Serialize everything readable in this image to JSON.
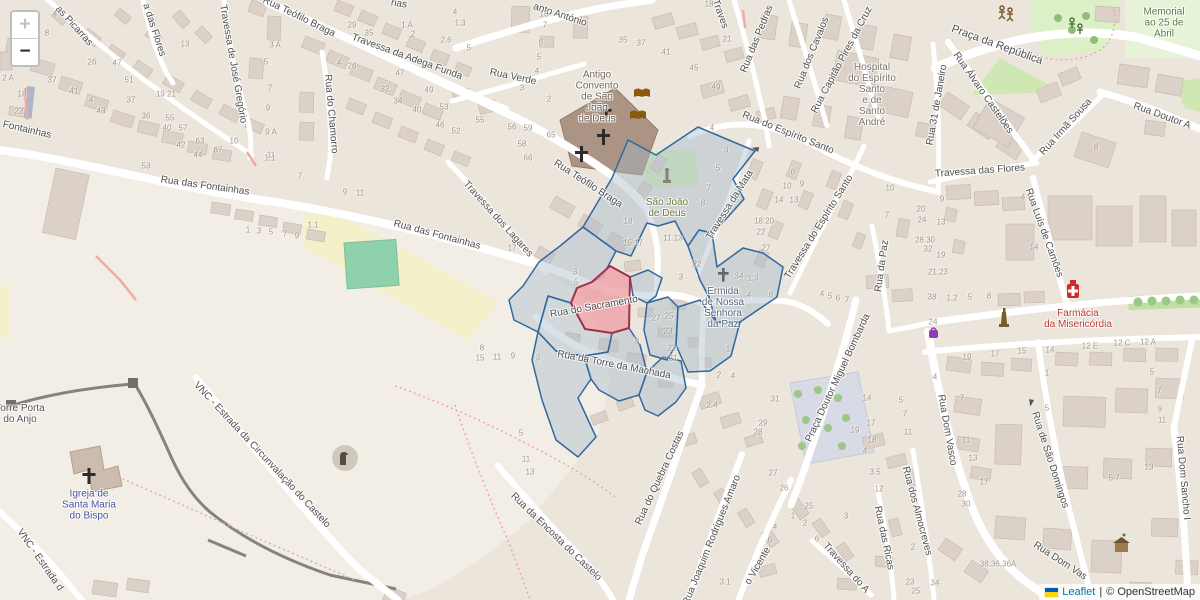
{
  "controls": {
    "zoom_in": "+",
    "zoom_out": "−"
  },
  "attribution": {
    "leaflet": "Leaflet",
    "separator": "|",
    "osm": "© OpenStreetMap"
  },
  "colors": {
    "overlay_stroke": "#31689e",
    "overlay_fill": "rgba(164,183,203,0.42)",
    "selected_stroke": "#a23148",
    "selected_fill": "rgba(237,166,171,0.85)",
    "link": "#0078a8"
  },
  "icons": [
    "church-cross-icon",
    "book-icon",
    "statue-icon",
    "monument-icon",
    "pharmacy-icon",
    "shop-icon",
    "gate-icon",
    "historic-house-icon",
    "castle-tower-icon",
    "playground-icon",
    "tree-icon",
    "oneway-arrow-icon",
    "ukraine-flag-icon",
    "zoom-in-icon",
    "zoom-out-icon"
  ],
  "map": {
    "streets": [
      [
        "Fontainhas",
        27,
        130,
        13
      ],
      [
        "as Picarras",
        74,
        26,
        48
      ],
      [
        "a das Flores",
        154,
        30,
        72
      ],
      [
        "Travessa de José Gregório",
        233,
        64,
        80
      ],
      [
        "Rua Teófilo Braga",
        299,
        17,
        26
      ],
      [
        "rias",
        399,
        4,
        8
      ],
      [
        "Travessa da Adega Funda",
        407,
        57,
        20
      ],
      [
        "Rua Verde",
        513,
        77,
        12
      ],
      [
        "Rua do Chamorro",
        331,
        114,
        85
      ],
      [
        "anto António",
        560,
        15,
        18
      ],
      [
        "Traves",
        720,
        14,
        70
      ],
      [
        "Rua das Pedras",
        757,
        39,
        -68
      ],
      [
        "Rua dos Cavalos",
        812,
        53,
        -68
      ],
      [
        "Rua Capitão Pires da Cruz",
        842,
        60,
        -62
      ],
      [
        "Rua do Espírito Santo",
        788,
        133,
        22
      ],
      [
        "Rua 31 de Janeiro",
        937,
        105,
        -80
      ],
      [
        "Praça da República",
        997,
        45,
        20,
        11
      ],
      [
        "Rua Álvaro Castelões",
        983,
        93,
        55
      ],
      [
        "Rua Irmã Sousa",
        1066,
        127,
        -48
      ],
      [
        "Rua Doutor A",
        1162,
        116,
        20
      ],
      [
        "Travessa das Flores",
        980,
        171,
        -4
      ],
      [
        "Rua Luís de Camões",
        1044,
        233,
        70
      ],
      [
        "Rua da Paz",
        882,
        266,
        -82
      ],
      [
        "Travessa do Espírito Santo",
        819,
        227,
        -58
      ],
      [
        "Travessa da Mata",
        730,
        205,
        -58
      ],
      [
        "Rua Teófilo Braga",
        588,
        184,
        33
      ],
      [
        "Travessa dos Lagares",
        498,
        219,
        48
      ],
      [
        "Rua das Fontainhas",
        205,
        186,
        8
      ],
      [
        "Rua das Fontainhas",
        437,
        235,
        15
      ],
      [
        "Rua do Sacramento",
        594,
        307,
        -10
      ],
      [
        "Rua da Torre da Machada",
        614,
        365,
        11
      ],
      [
        "Rua do Quebra Costas",
        660,
        478,
        -65
      ],
      [
        "Rua Joaquim Rodrigues Amaro",
        712,
        540,
        -68
      ],
      [
        "Praça Doutor Miguel Bombarda",
        838,
        378,
        -65
      ],
      [
        "o Vicente",
        758,
        566,
        -60
      ],
      [
        "Travessa do A",
        846,
        568,
        48
      ],
      [
        "Rua das Ricas",
        884,
        538,
        78
      ],
      [
        "Rua dos Almocreves",
        917,
        511,
        75
      ],
      [
        "Rua Dom Vasco",
        947,
        430,
        80
      ],
      [
        "Rua Dom Vas",
        1060,
        561,
        33
      ],
      [
        "Rua de São Domingos",
        1050,
        460,
        72
      ],
      [
        "Rua Dom Sancho I",
        1183,
        478,
        85
      ],
      [
        "VNC - Estrada da Circunvalação do Castelo",
        262,
        455,
        47
      ],
      [
        "VNC - Estrada d",
        40,
        560,
        55
      ],
      [
        "Rua da Encosta do Castelo",
        556,
        537,
        44
      ]
    ],
    "places": [
      [
        "Antigo\nConvento\nde São\nJoão\nde Deus",
        597,
        97,
        "#75695c"
      ],
      [
        "São João\nde Deus",
        667,
        208,
        "#6f7a3e"
      ],
      [
        "Ermida\nde Nossa\nSenhora\nda Paz",
        723,
        308,
        "#5b6b7c"
      ],
      [
        "Hospital\ndo Espírito\nSanto\ne de\nSanto\nAndré",
        872,
        95,
        "#7d746a"
      ],
      [
        "Torre Porta\ndo Anjo",
        20,
        414,
        "#565656"
      ],
      [
        "Igreja de\nSanta Maria\ndo Bispo",
        89,
        505,
        "#4a549e"
      ],
      [
        "Farmácia\nda Misericórdia",
        1078,
        319,
        "#bf3a34"
      ],
      [
        "Memorial\nao 25 de\nAbril",
        1164,
        23,
        "#5a7d46"
      ]
    ],
    "house_numbers": [
      [
        "4",
        55,
        14
      ],
      [
        "8",
        47,
        33
      ],
      [
        "13",
        185,
        44
      ],
      [
        "26",
        92,
        62
      ],
      [
        "47",
        117,
        63
      ],
      [
        "51",
        129,
        80
      ],
      [
        "37",
        52,
        80
      ],
      [
        "41",
        74,
        91
      ],
      [
        "4",
        91,
        100
      ],
      [
        "43",
        101,
        111
      ],
      [
        "37",
        131,
        100
      ],
      [
        "36",
        146,
        116
      ],
      [
        "55",
        170,
        118
      ],
      [
        "40",
        167,
        128
      ],
      [
        "57",
        183,
        128
      ],
      [
        "42",
        181,
        145
      ],
      [
        "63",
        200,
        141
      ],
      [
        "44",
        198,
        155
      ],
      [
        "67",
        218,
        150
      ],
      [
        "10",
        234,
        141
      ],
      [
        "18",
        22,
        94
      ],
      [
        "22",
        19,
        111
      ],
      [
        "2 A",
        8,
        78
      ],
      [
        "3 A",
        275,
        45
      ],
      [
        "5",
        266,
        62
      ],
      [
        "7",
        270,
        88
      ],
      [
        "9",
        268,
        108
      ],
      [
        "9 A",
        271,
        132
      ],
      [
        "11",
        271,
        155
      ],
      [
        "19.21",
        166,
        94
      ],
      [
        "29",
        352,
        25
      ],
      [
        "35",
        369,
        33
      ],
      [
        "1 A",
        407,
        25
      ],
      [
        "2",
        413,
        34
      ],
      [
        "2.6",
        446,
        40
      ],
      [
        "5",
        469,
        48
      ],
      [
        "4",
        455,
        12
      ],
      [
        "1.3",
        460,
        23
      ],
      [
        "18",
        544,
        14
      ],
      [
        "7",
        545,
        25
      ],
      [
        "6",
        541,
        42
      ],
      [
        "5",
        539,
        57
      ],
      [
        "4",
        537,
        71
      ],
      [
        "3",
        522,
        88
      ],
      [
        "2",
        549,
        99
      ],
      [
        "4",
        339,
        63
      ],
      [
        "26",
        352,
        66
      ],
      [
        "47",
        400,
        73
      ],
      [
        "32",
        385,
        89
      ],
      [
        "49",
        429,
        90
      ],
      [
        "34",
        398,
        101
      ],
      [
        "40",
        417,
        110
      ],
      [
        "53",
        444,
        107
      ],
      [
        "46",
        440,
        125
      ],
      [
        "52",
        456,
        131
      ],
      [
        "55",
        480,
        120
      ],
      [
        "56",
        512,
        127
      ],
      [
        "59",
        528,
        128
      ],
      [
        "65",
        551,
        135
      ],
      [
        "58",
        522,
        144
      ],
      [
        "66",
        528,
        158
      ],
      [
        "35",
        623,
        40
      ],
      [
        "37",
        641,
        43
      ],
      [
        "41",
        666,
        52
      ],
      [
        "45",
        694,
        68
      ],
      [
        "49",
        716,
        87
      ],
      [
        "21",
        727,
        39
      ],
      [
        "18",
        709,
        4
      ],
      [
        "4",
        712,
        128
      ],
      [
        "53",
        146,
        166
      ],
      [
        "1.1",
        270,
        158
      ],
      [
        "7",
        300,
        176
      ],
      [
        "1",
        248,
        230
      ],
      [
        "3",
        259,
        231
      ],
      [
        "5",
        271,
        232
      ],
      [
        "7",
        285,
        234
      ],
      [
        "9",
        297,
        236
      ],
      [
        "1.1",
        313,
        225
      ],
      [
        "9",
        345,
        192
      ],
      [
        "11",
        360,
        193
      ],
      [
        "17",
        512,
        248
      ],
      [
        "15.17",
        633,
        243
      ],
      [
        "18",
        628,
        221
      ],
      [
        "11.13",
        673,
        238
      ],
      [
        "22",
        697,
        264
      ],
      [
        "3",
        681,
        277
      ],
      [
        "3",
        575,
        272
      ],
      [
        "5",
        576,
        282
      ],
      [
        "3",
        726,
        150
      ],
      [
        "5",
        718,
        168
      ],
      [
        "7",
        709,
        188
      ],
      [
        "8",
        703,
        203
      ],
      [
        "6",
        793,
        172
      ],
      [
        "10",
        787,
        186
      ],
      [
        "9",
        802,
        184
      ],
      [
        "14",
        779,
        200
      ],
      [
        "13",
        794,
        200
      ],
      [
        "18.20",
        764,
        221
      ],
      [
        "22",
        761,
        232
      ],
      [
        "27",
        766,
        248
      ],
      [
        "34",
        739,
        276
      ],
      [
        "1.3",
        753,
        278
      ],
      [
        "4",
        749,
        295
      ],
      [
        "8",
        771,
        295
      ],
      [
        "4",
        822,
        294
      ],
      [
        "5",
        830,
        296
      ],
      [
        "6",
        838,
        298
      ],
      [
        "7",
        847,
        300
      ],
      [
        "10",
        890,
        188
      ],
      [
        "7",
        887,
        215
      ],
      [
        "20",
        921,
        209
      ],
      [
        "24",
        922,
        220
      ],
      [
        "28.30",
        925,
        240
      ],
      [
        "32",
        928,
        249
      ],
      [
        "38",
        932,
        297
      ],
      [
        "8",
        1096,
        147
      ],
      [
        "9",
        942,
        199
      ],
      [
        "13",
        941,
        222
      ],
      [
        "19",
        941,
        255
      ],
      [
        "21.23",
        938,
        272
      ],
      [
        "1.2",
        952,
        298
      ],
      [
        "5",
        970,
        297
      ],
      [
        "8",
        989,
        296
      ],
      [
        "4",
        1023,
        197
      ],
      [
        "14",
        1034,
        247
      ],
      [
        "24",
        933,
        322
      ],
      [
        "27",
        656,
        318
      ],
      [
        "25",
        669,
        316
      ],
      [
        "23",
        668,
        331
      ],
      [
        "22",
        672,
        348
      ],
      [
        "21",
        673,
        358
      ],
      [
        "8",
        637,
        341
      ],
      [
        "15",
        480,
        358
      ],
      [
        "11",
        497,
        357
      ],
      [
        "9",
        513,
        356
      ],
      [
        "3",
        538,
        358
      ],
      [
        "8",
        482,
        348
      ],
      [
        "1",
        728,
        349
      ],
      [
        "2",
        719,
        375
      ],
      [
        "4",
        733,
        376
      ],
      [
        "2.4",
        712,
        405
      ],
      [
        "5",
        521,
        433
      ],
      [
        "11",
        526,
        459
      ],
      [
        "13",
        530,
        472
      ],
      [
        "31",
        775,
        399
      ],
      [
        "29",
        763,
        423
      ],
      [
        "28",
        758,
        432
      ],
      [
        "27",
        773,
        473
      ],
      [
        "26",
        784,
        488
      ],
      [
        "25",
        809,
        506
      ],
      [
        "1",
        793,
        516
      ],
      [
        "2",
        805,
        523
      ],
      [
        "6",
        817,
        539
      ],
      [
        "4",
        775,
        527
      ],
      [
        "6",
        770,
        540
      ],
      [
        "14",
        867,
        398
      ],
      [
        "5",
        901,
        400
      ],
      [
        "7",
        905,
        414
      ],
      [
        "11",
        908,
        432
      ],
      [
        "17",
        871,
        423
      ],
      [
        "19",
        855,
        430
      ],
      [
        "18",
        872,
        440
      ],
      [
        "4",
        865,
        451
      ],
      [
        "3.5",
        875,
        472
      ],
      [
        "12",
        879,
        489
      ],
      [
        "3",
        846,
        516
      ],
      [
        "23",
        910,
        582
      ],
      [
        "25",
        916,
        591
      ],
      [
        "3.1",
        725,
        582
      ],
      [
        "2",
        913,
        547
      ],
      [
        "19",
        967,
        357
      ],
      [
        "17",
        995,
        354
      ],
      [
        "15",
        1022,
        351
      ],
      [
        "14",
        1050,
        350
      ],
      [
        "12 E",
        1090,
        346
      ],
      [
        "12 C",
        1122,
        343
      ],
      [
        "12 A",
        1148,
        342
      ],
      [
        "1",
        1047,
        373
      ],
      [
        "5",
        1152,
        372
      ],
      [
        "7",
        1159,
        391
      ],
      [
        "9",
        1160,
        409
      ],
      [
        "11",
        1162,
        420
      ],
      [
        "7",
        962,
        398
      ],
      [
        "11",
        966,
        440
      ],
      [
        "13",
        973,
        458
      ],
      [
        "17",
        984,
        482
      ],
      [
        "28",
        962,
        494
      ],
      [
        "30",
        966,
        504
      ],
      [
        "5",
        1047,
        408
      ],
      [
        "5.7",
        1114,
        478
      ],
      [
        "13",
        1149,
        467
      ],
      [
        "4",
        935,
        377
      ],
      [
        "38.36.36A",
        998,
        564
      ],
      [
        "34",
        935,
        583
      ]
    ]
  }
}
